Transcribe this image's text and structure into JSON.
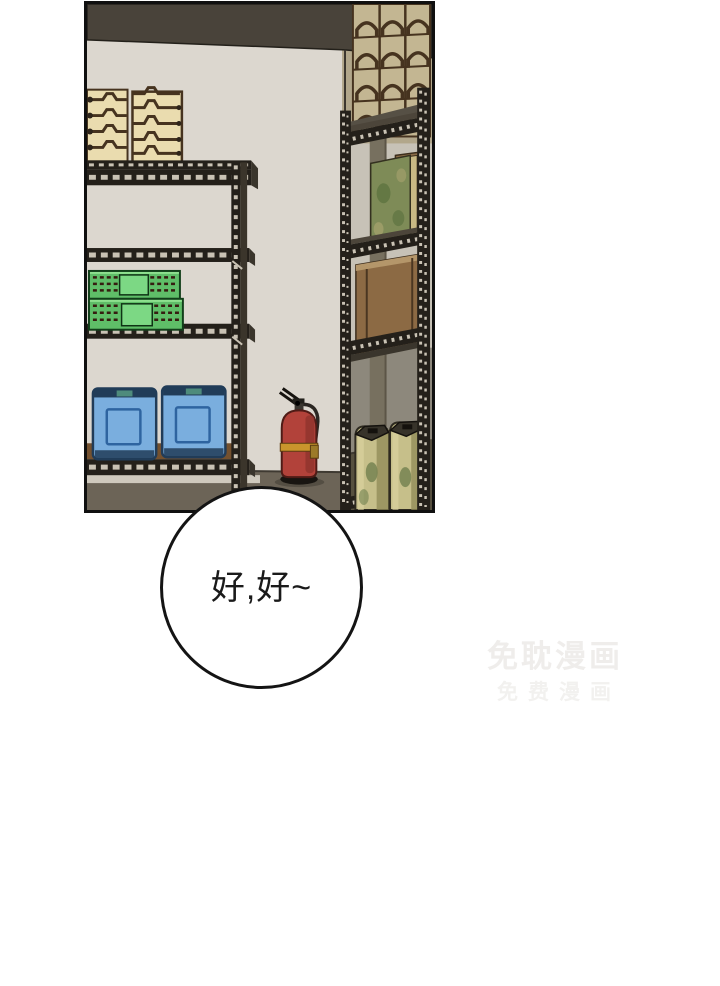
{
  "scene": {
    "panel_name": "storage-room-panel",
    "objects": [
      "metal-shelf-left",
      "metal-shelf-right",
      "stacked-cream-trays",
      "green-vented-crates",
      "blue-water-containers",
      "fire-extinguisher",
      "cardboard-boxes",
      "camouflage-box",
      "khaki-gas-canisters"
    ]
  },
  "speech_bubble": {
    "text": "好,好~"
  },
  "watermark": {
    "line1": "免耽漫画",
    "line2": "免费漫画"
  },
  "colors": {
    "wall": "#dcd7cf",
    "ceiling": "#49433a",
    "side_wall": "#b2a78b",
    "interior_light": "#c7c2b7",
    "interior_dim": "#8d887c",
    "floor": "#6c6457",
    "floor_dark": "#56503f",
    "baseboard": "#cfc9bd",
    "metal": "#24201a",
    "metal_side": "#4c453a",
    "metal_shadow": "#3a352c",
    "dots": "#c9c2b4",
    "pillar": "#77705f",
    "wood": "#74512f",
    "tray_cream": "#eadcaf",
    "tray_tan": "#c3b692",
    "tray_line": "#46331f",
    "crate_green": "#5fbe68",
    "crate_green_light": "#7cd884",
    "slot_dark": "#361c10",
    "can_blue": "#7aaede",
    "can_navy": "#213c58",
    "can_inner": "#2e64a0",
    "can_teal": "#4e8b7c",
    "box_brown": "#8a6b46",
    "box_brown_light": "#b4966a",
    "box_camo": "#7e8b57",
    "camo_dark": "#5e7340",
    "camo_light": "#a3a06b",
    "khaki": "#c9b984",
    "canister": "#c6bf8a",
    "canister_shadow": "#8f8a55",
    "canister_green": "#70804e",
    "canister_top": "#37332a",
    "ext_red": "#b2423a",
    "ext_dark_red": "#8f332d",
    "ext_band": "#c9952c",
    "ext_metal": "#16130f",
    "bubble_border": "#141414",
    "text": "#1a1a1a",
    "wm1": "#efedeb",
    "wm2": "#f2f1ef"
  }
}
